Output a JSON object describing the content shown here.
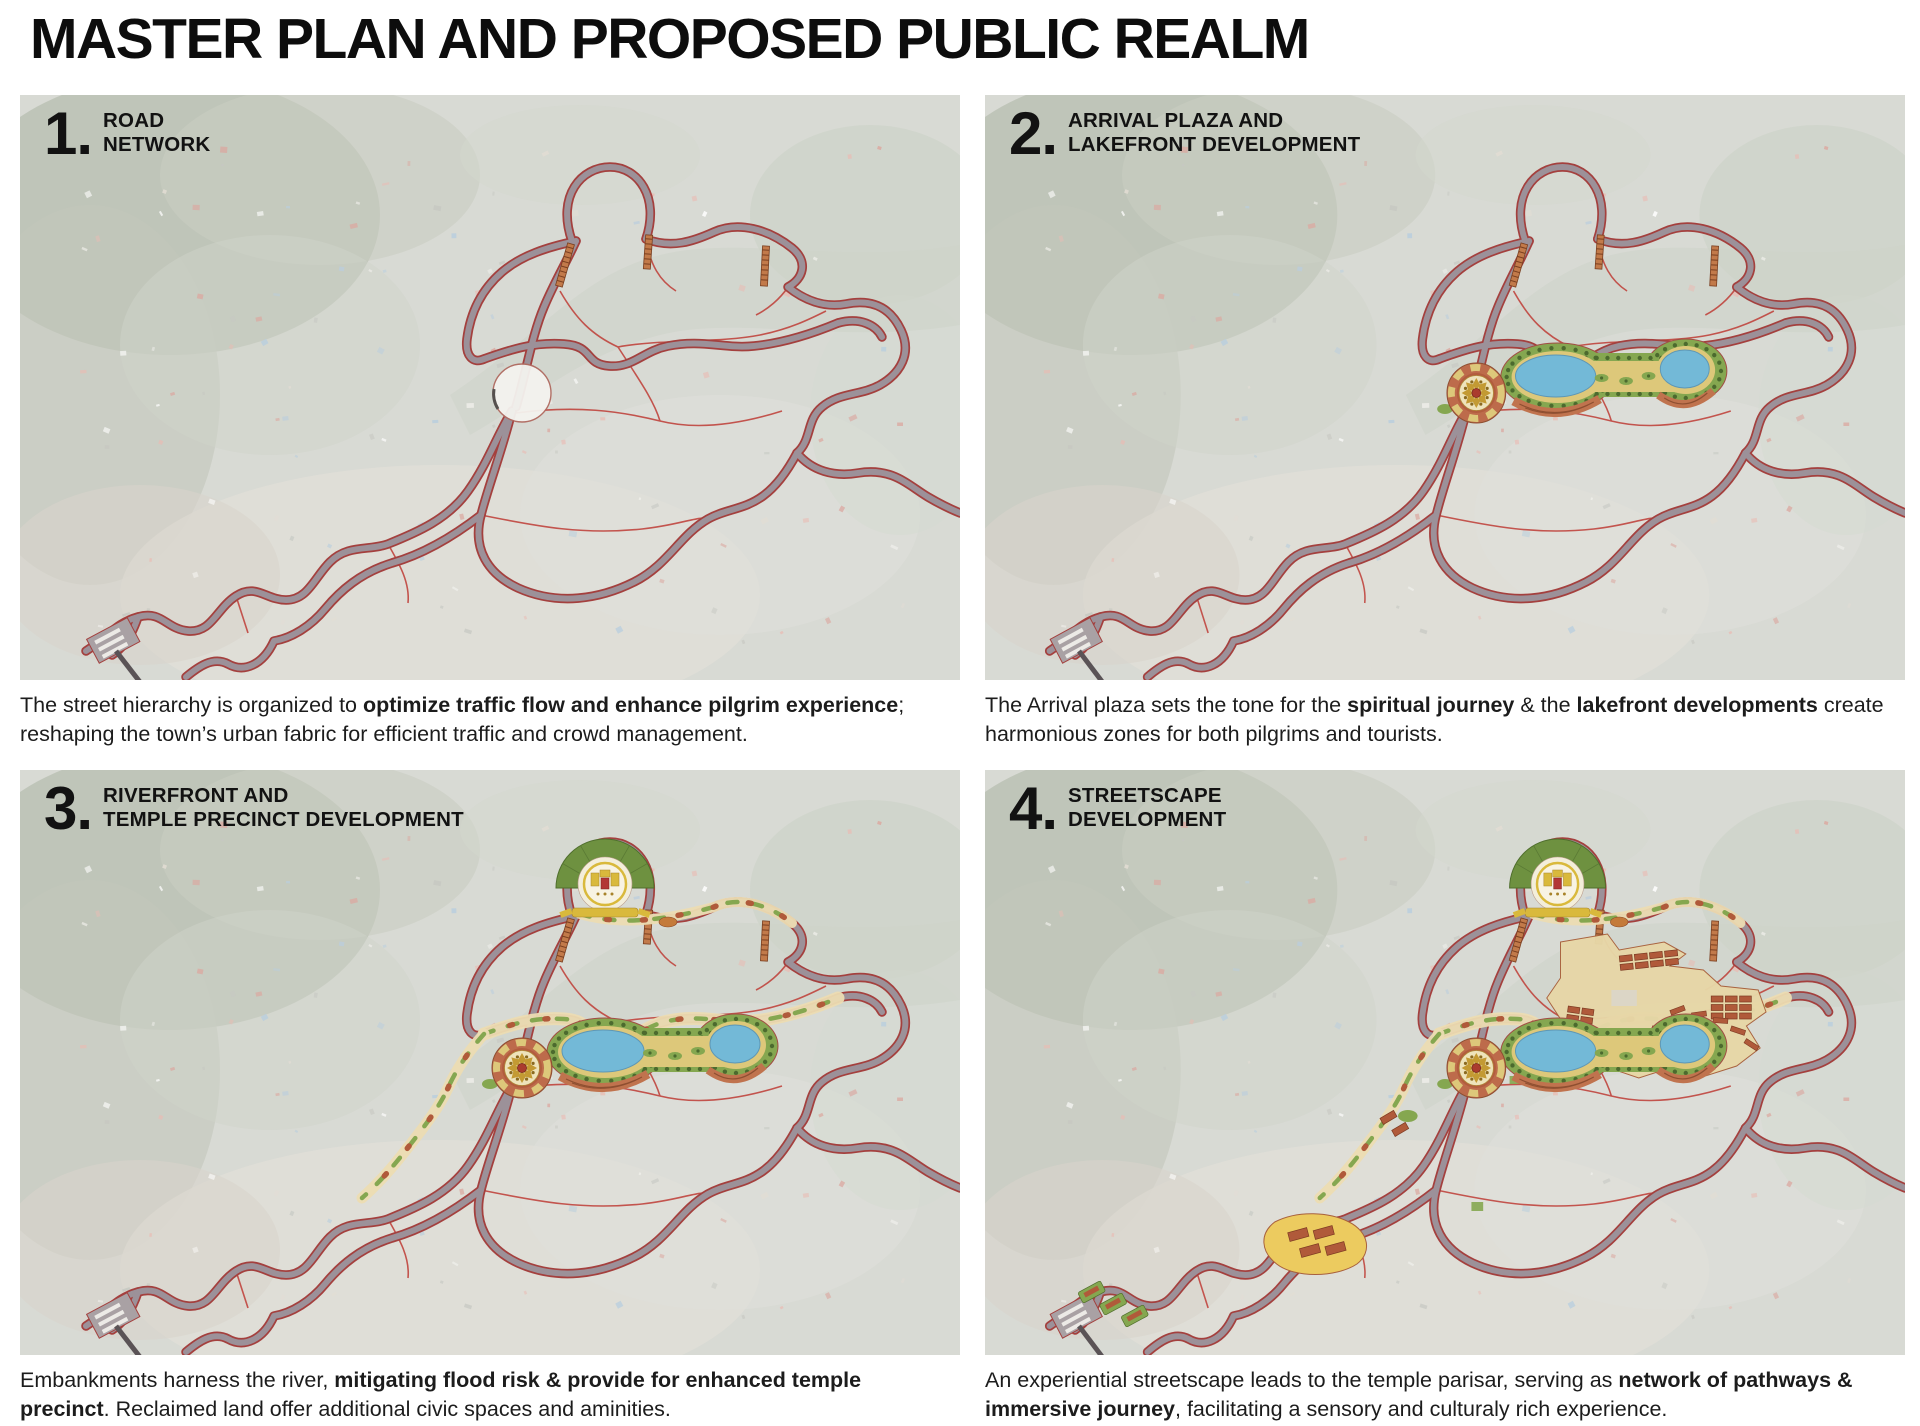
{
  "page": {
    "title": "MASTER PLAN AND PROPOSED PUBLIC REALM"
  },
  "colors": {
    "accent_red": "#a4403e",
    "road_gray": "#9c9199",
    "thin_red": "#c0453e",
    "bridge_orange": "#c27a4a",
    "satellite_base": "#d8dad4",
    "forest_gray": "#b7bdb0",
    "river_valley": "#cdd4c9",
    "lake_blue": "#73b9d7",
    "park_green": "#85a750",
    "tree_green": "#4c6a2e",
    "path_yellow": "#ddc87a",
    "embankment_terracotta": "#c0734e",
    "building_terracotta": "#b05a3a",
    "plaza_tan": "#e7d7a7",
    "temple_green": "#6e9140",
    "temple_yellow": "#d9b93c",
    "temple_red": "#b23636",
    "market_yellow": "#eccb5f",
    "roundabout_white": "#f4f3ef"
  },
  "panels": [
    {
      "number": "1.",
      "title_lines": [
        "ROAD",
        "NETWORK"
      ],
      "features": [
        "roads"
      ],
      "caption": [
        {
          "text": "The street hierarchy is organized to ",
          "bold": false
        },
        {
          "text": "optimize traffic flow and enhance pilgrim experience",
          "bold": true
        },
        {
          "text": "; reshaping the town’s urban fabric for efficient traffic and crowd management.",
          "bold": false
        }
      ]
    },
    {
      "number": "2.",
      "title_lines": [
        "ARRIVAL PLAZA AND",
        "LAKEFRONT DEVELOPMENT"
      ],
      "features": [
        "roads",
        "lakefront"
      ],
      "caption": [
        {
          "text": "The Arrival plaza sets the tone for the ",
          "bold": false
        },
        {
          "text": "spiritual journey",
          "bold": true
        },
        {
          "text": " & the ",
          "bold": false
        },
        {
          "text": "lakefront developments",
          "bold": true
        },
        {
          "text": " create harmonious zones for both pilgrims and tourists.",
          "bold": false
        }
      ]
    },
    {
      "number": "3.",
      "title_lines": [
        "RIVERFRONT AND",
        "TEMPLE PRECINCT DEVELOPMENT"
      ],
      "features": [
        "roads",
        "lakefront",
        "riverfront"
      ],
      "caption": [
        {
          "text": "Embankments harness the river, ",
          "bold": false
        },
        {
          "text": "mitigating flood risk & provide for enhanced temple precinct",
          "bold": true
        },
        {
          "text": ". Reclaimed land offer additional civic spaces and aminities.",
          "bold": false
        }
      ]
    },
    {
      "number": "4.",
      "title_lines": [
        "STREETSCAPE",
        "DEVELOPMENT"
      ],
      "features": [
        "roads",
        "lakefront",
        "riverfront",
        "streetscape"
      ],
      "caption": [
        {
          "text": "An experiential streetscape leads to the temple parisar, serving as ",
          "bold": false
        },
        {
          "text": "network of pathways & immersive journey",
          "bold": true
        },
        {
          "text": ", facilitating a sensory and culturaly rich experience.",
          "bold": false
        }
      ]
    }
  ]
}
